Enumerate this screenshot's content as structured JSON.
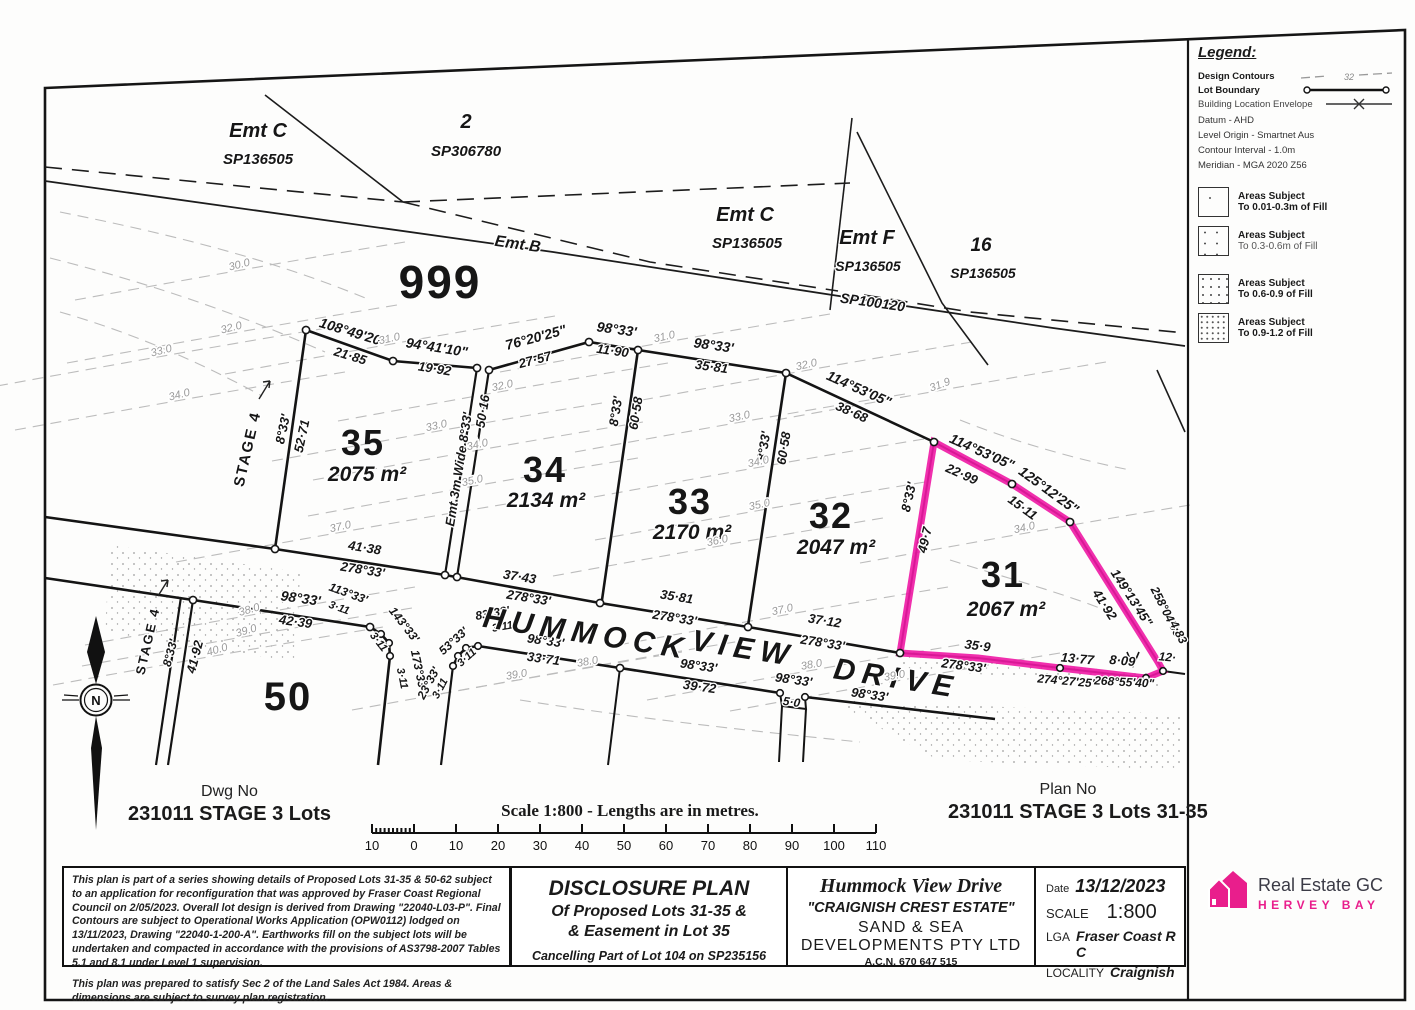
{
  "titles": {
    "dwg_label": "Dwg No",
    "dwg_no": "231011 STAGE 3 Lots",
    "plan_label": "Plan No",
    "plan_no": "231011 STAGE 3 Lots 31-35",
    "scale_caption": "Scale 1:800 - Lengths are in metres."
  },
  "scalebar": {
    "ticks": [
      "10",
      "0",
      "10",
      "20",
      "30",
      "40",
      "50",
      "60",
      "70",
      "80",
      "90",
      "100",
      "110"
    ]
  },
  "legend": {
    "title": "Legend:",
    "line_items": [
      {
        "label": "Design Contours"
      },
      {
        "label": "Lot Boundary"
      },
      {
        "label": "Building Location Envelope"
      }
    ],
    "contour_sample_value": "32",
    "notes": [
      "Datum - AHD",
      "Level Origin - Smartnet Aus",
      "Contour Interval - 1.0m",
      "Meridian - MGA 2020 Z56"
    ],
    "fill_items": [
      {
        "line1": "Areas Subject",
        "line2": "To 0.01-0.3m of Fill"
      },
      {
        "line1": "Areas Subject",
        "line2": "To 0.3-0.6m of Fill"
      },
      {
        "line1": "Areas Subject",
        "line2": "To 0.6-0.9 of Fill"
      },
      {
        "line1": "Areas Subject",
        "line2": "To 0.9-1.2 of Fill"
      }
    ]
  },
  "title_block": {
    "notes_par1": "This plan is part of a series showing details of Proposed Lots 31-35 & 50-62 subject to an application for reconfiguration that was approved by Fraser Coast Regional Council on 2/05/2023. Overall lot design is derived from Drawing \"22040-L03-P\". Final Contours are subject to Operational Works Application (OPW0112) lodged on 13/11/2023, Drawing \"22040-1-200-A\". Earthworks fill on the subject lots will be undertaken and compacted in accordance with the provisions of AS3798-2007 Tables 5.1 and 8.1 under Level 1 supervision.",
    "notes_par2": "This plan was prepared to satisfy Sec 2 of the Land Sales Act 1984. Areas & dimensions are subject to survey plan registration.",
    "disclosure": {
      "title": "DISCLOSURE PLAN",
      "line1": "Of Proposed Lots 31-35 &",
      "line2": "& Easement in Lot 35",
      "line3": "Cancelling Part of Lot 104 on SP235156"
    },
    "estate": {
      "road": "Hummock View Drive",
      "estate": "\"CRAIGNISH CREST ESTATE\"",
      "dev1": "SAND & SEA",
      "dev2": "DEVELOPMENTS PTY LTD",
      "acn": "A.C.N. 670 647 515"
    },
    "details": {
      "date_label": "Date",
      "date": "13/12/2023",
      "scale_label": "SCALE",
      "scale": "1:800",
      "lga_label": "LGA",
      "lga": "Fraser Coast R C",
      "locality_label": "LOCALITY",
      "locality": "Craignish"
    }
  },
  "logo": {
    "name": "Real Estate GC",
    "sub": "HERVEY BAY",
    "accent": "#e91e8c"
  },
  "plan": {
    "highlight_color": "#ee18a4",
    "labels": [
      [
        "Emt C",
        258,
        137,
        0,
        20,
        "par"
      ],
      [
        "SP136505",
        258,
        164,
        0,
        15,
        "sp"
      ],
      [
        "2",
        466,
        128,
        0,
        20,
        "par"
      ],
      [
        "SP306780",
        466,
        156,
        0,
        15,
        "sp"
      ],
      [
        "Emt B",
        517,
        249,
        8,
        16,
        "par"
      ],
      [
        "999",
        440,
        298,
        0,
        46,
        "lot"
      ],
      [
        "Emt C",
        745,
        221,
        0,
        20,
        "par"
      ],
      [
        "SP136505",
        747,
        248,
        0,
        15,
        "sp"
      ],
      [
        "Emt F",
        867,
        244,
        0,
        20,
        "par"
      ],
      [
        "SP136505",
        868,
        271,
        0,
        14,
        "sp"
      ],
      [
        "16",
        981,
        251,
        0,
        19,
        "par"
      ],
      [
        "SP136505",
        983,
        278,
        0,
        14,
        "sp"
      ],
      [
        "SP100120",
        872,
        307,
        8,
        14,
        "sp"
      ],
      [
        "STAGE 4",
        252,
        450,
        -77,
        15,
        "stage"
      ],
      [
        "STAGE 4",
        152,
        642,
        -77,
        13,
        "stage"
      ],
      [
        "8°33'",
        287,
        430,
        -78,
        13,
        "b"
      ],
      [
        "52·71",
        306,
        437,
        -78,
        13,
        "d"
      ],
      [
        "108°49'20\"",
        352,
        337,
        17,
        14,
        "b"
      ],
      [
        "21·85",
        349,
        360,
        17,
        13,
        "d"
      ],
      [
        "94°41'10\"",
        436,
        352,
        9,
        14,
        "b"
      ],
      [
        "19·92",
        434,
        373,
        9,
        13,
        "d"
      ],
      [
        "76°20'25\"",
        537,
        342,
        -15,
        14,
        "b"
      ],
      [
        "27·57",
        536,
        364,
        -15,
        13,
        "d"
      ],
      [
        "98°33'",
        616,
        334,
        8,
        14,
        "b"
      ],
      [
        "11·90",
        612,
        355,
        8,
        13,
        "d"
      ],
      [
        "98°33'",
        713,
        350,
        8,
        14,
        "b"
      ],
      [
        "35·81",
        711,
        371,
        8,
        13,
        "d"
      ],
      [
        "114°53'05\"",
        857,
        393,
        24,
        14,
        "b"
      ],
      [
        "38·68",
        850,
        416,
        24,
        13,
        "d"
      ],
      [
        "114°53'05\"",
        980,
        456,
        24,
        14,
        "b"
      ],
      [
        "22·99",
        960,
        478,
        24,
        13,
        "d"
      ],
      [
        "125°12'25\"",
        1046,
        494,
        36,
        14,
        "b"
      ],
      [
        "15·11",
        1020,
        511,
        36,
        13,
        "d"
      ],
      [
        "Emt  3m Wide  8°33'",
        463,
        470,
        -81,
        13,
        "b"
      ],
      [
        "50·16",
        487,
        412,
        -81,
        13,
        "d"
      ],
      [
        "8°33'",
        620,
        412,
        -81,
        13,
        "b"
      ],
      [
        "60·58",
        640,
        414,
        -81,
        13,
        "d"
      ],
      [
        "8°33'",
        768,
        447,
        -81,
        13,
        "b"
      ],
      [
        "60·58",
        788,
        449,
        -81,
        13,
        "d"
      ],
      [
        "8°33'",
        913,
        498,
        -77,
        13,
        "b"
      ],
      [
        "49·7",
        929,
        541,
        -77,
        13,
        "d"
      ],
      [
        "149°13'45\"",
        1128,
        600,
        57,
        13,
        "b"
      ],
      [
        "41·92",
        1101,
        607,
        57,
        13,
        "d"
      ],
      [
        "258°04'05\"",
        1164,
        616,
        63,
        12,
        "b"
      ],
      [
        "4·83",
        1175,
        634,
        63,
        12,
        "d"
      ],
      [
        "41·38",
        364,
        552,
        9,
        13,
        "d"
      ],
      [
        "278°33'",
        362,
        574,
        9,
        13,
        "b"
      ],
      [
        "37·43",
        519,
        581,
        9,
        13,
        "d"
      ],
      [
        "278°33'",
        528,
        602,
        9,
        13,
        "b"
      ],
      [
        "35·81",
        676,
        601,
        9,
        13,
        "d"
      ],
      [
        "278°33'",
        674,
        622,
        9,
        13,
        "b"
      ],
      [
        "37·12",
        824,
        625,
        9,
        13,
        "d"
      ],
      [
        "278°33'",
        822,
        647,
        9,
        13,
        "b"
      ],
      [
        "35·9",
        977,
        650,
        7,
        13,
        "d"
      ],
      [
        "278°33'",
        963,
        670,
        7,
        13,
        "b"
      ],
      [
        "13·77",
        1077,
        663,
        5,
        13,
        "d"
      ],
      [
        "274°27'25\"",
        1067,
        685,
        5,
        12,
        "b"
      ],
      [
        "8·09",
        1122,
        665,
        5,
        13,
        "d"
      ],
      [
        "268°55'40\"",
        1124,
        686,
        3,
        12,
        "b"
      ],
      [
        "12·",
        1167,
        661,
        5,
        12,
        "d"
      ],
      [
        "98°33'",
        300,
        603,
        8,
        14,
        "b"
      ],
      [
        "42·39",
        295,
        626,
        8,
        13,
        "d"
      ],
      [
        "113°33'",
        347,
        597,
        20,
        12,
        "b"
      ],
      [
        "3·11",
        338,
        611,
        20,
        11,
        "d"
      ],
      [
        "143°33'",
        401,
        627,
        52,
        12,
        "b"
      ],
      [
        "3·11",
        376,
        644,
        52,
        11,
        "d"
      ],
      [
        "173°33'",
        415,
        671,
        78,
        12,
        "b"
      ],
      [
        "3·11",
        399,
        679,
        78,
        11,
        "d"
      ],
      [
        "23°33'",
        432,
        685,
        -62,
        12,
        "b"
      ],
      [
        "3·11",
        443,
        690,
        -62,
        11,
        "d"
      ],
      [
        "53°33'",
        456,
        644,
        -42,
        12,
        "b"
      ],
      [
        "3·11",
        469,
        660,
        -42,
        11,
        "d"
      ],
      [
        "83°33'",
        493,
        617,
        -10,
        12,
        "b"
      ],
      [
        "3·11",
        503,
        630,
        -10,
        11,
        "d"
      ],
      [
        "98°33'",
        545,
        645,
        8,
        13,
        "b"
      ],
      [
        "33·71",
        543,
        663,
        8,
        13,
        "d"
      ],
      [
        "98°33'",
        698,
        670,
        8,
        13,
        "b"
      ],
      [
        "39·72",
        699,
        691,
        8,
        13,
        "d"
      ],
      [
        "98°33'",
        793,
        684,
        8,
        13,
        "b"
      ],
      [
        "5·0",
        791,
        706,
        8,
        12,
        "d"
      ],
      [
        "98°33'",
        869,
        699,
        8,
        13,
        "b"
      ],
      [
        "8°33'",
        174,
        654,
        -75,
        12,
        "b"
      ],
      [
        "41·92",
        199,
        658,
        -75,
        13,
        "d"
      ],
      [
        "35",
        363,
        455,
        0,
        36,
        "lot"
      ],
      [
        "2075 m²",
        367,
        481,
        0,
        21,
        "area"
      ],
      [
        "34",
        545,
        482,
        0,
        36,
        "lot"
      ],
      [
        "2134 m²",
        546,
        507,
        0,
        21,
        "area"
      ],
      [
        "33",
        690,
        514,
        0,
        36,
        "lot"
      ],
      [
        "2170 m²",
        692,
        539,
        0,
        21,
        "area"
      ],
      [
        "32",
        831,
        528,
        0,
        36,
        "lot"
      ],
      [
        "2047 m²",
        836,
        554,
        0,
        21,
        "area"
      ],
      [
        "31",
        1003,
        587,
        0,
        36,
        "lot"
      ],
      [
        "2067 m²",
        1006,
        616,
        0,
        21,
        "area"
      ],
      [
        "50",
        288,
        710,
        0,
        40,
        "lot"
      ],
      [
        "HUMMOCK",
        585,
        643,
        9,
        30,
        "road"
      ],
      [
        "VIEW",
        742,
        658,
        9,
        30,
        "road"
      ],
      [
        "DRIVE",
        895,
        688,
        9,
        30,
        "road"
      ],
      [
        "30.0",
        240,
        268,
        -14,
        11,
        "c"
      ],
      [
        "32.0",
        232,
        331,
        -14,
        11,
        "c"
      ],
      [
        "33.0",
        162,
        354,
        -14,
        11,
        "c"
      ],
      [
        "34.0",
        180,
        398,
        -14,
        11,
        "c"
      ],
      [
        "31.0",
        390,
        342,
        -12,
        11,
        "c"
      ],
      [
        "32.0",
        503,
        389,
        -12,
        11,
        "c"
      ],
      [
        "33.0",
        437,
        429,
        -12,
        11,
        "c"
      ],
      [
        "34.0",
        478,
        448,
        -12,
        11,
        "c"
      ],
      [
        "35.0",
        473,
        484,
        -12,
        11,
        "c"
      ],
      [
        "37.0",
        341,
        530,
        -12,
        11,
        "c"
      ],
      [
        "31.0",
        665,
        340,
        -12,
        11,
        "c"
      ],
      [
        "32.0",
        807,
        368,
        -12,
        11,
        "c"
      ],
      [
        "33.0",
        740,
        420,
        -12,
        11,
        "c"
      ],
      [
        "34.0",
        759,
        465,
        -12,
        11,
        "c"
      ],
      [
        "35.0",
        760,
        508,
        -12,
        11,
        "c"
      ],
      [
        "36.0",
        718,
        544,
        -12,
        11,
        "c"
      ],
      [
        "37.0",
        783,
        613,
        -12,
        11,
        "c"
      ],
      [
        "31.9",
        941,
        388,
        -20,
        11,
        "c"
      ],
      [
        "34.0",
        1025,
        531,
        -12,
        11,
        "c"
      ],
      [
        "38.0",
        250,
        613,
        -16,
        11,
        "c"
      ],
      [
        "39.0",
        247,
        634,
        -16,
        11,
        "c"
      ],
      [
        "40.0",
        218,
        653,
        -16,
        11,
        "c"
      ],
      [
        "38.0",
        588,
        665,
        -10,
        11,
        "c"
      ],
      [
        "39.0",
        517,
        678,
        -10,
        11,
        "c"
      ],
      [
        "38.0",
        812,
        668,
        -10,
        11,
        "c"
      ],
      [
        "39.0",
        895,
        679,
        -10,
        11,
        "c"
      ]
    ]
  }
}
